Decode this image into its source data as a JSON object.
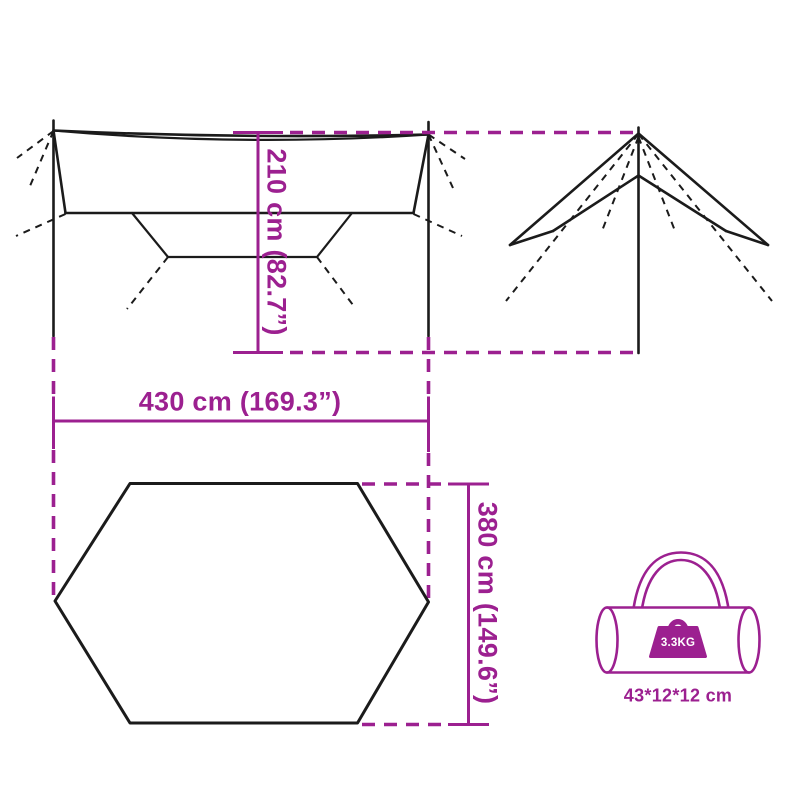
{
  "page": {
    "title": "tarp dimensions diagram",
    "background": "#ffffff"
  },
  "colors": {
    "accent_magenta": "#9c2090",
    "diagram_line_black": "#1b1b1b",
    "weight_text": "#ffffff"
  },
  "labels": {
    "height": "210 cm (82.7”)",
    "width": "430 cm (169.3”)",
    "depth": "380 cm (149.6”)",
    "bag_size": "43*12*12 cm",
    "bag_weight": "3.3KG"
  },
  "views": {
    "front": "tarp-front-elevation-with-poles-and-guy-lines",
    "side": "tarp-side-profile-with-pole-and-guy-lines",
    "top": "tarp-top-view-hexagon-outline",
    "bag": "carry-bag-with-handle-and-weight-icon"
  }
}
